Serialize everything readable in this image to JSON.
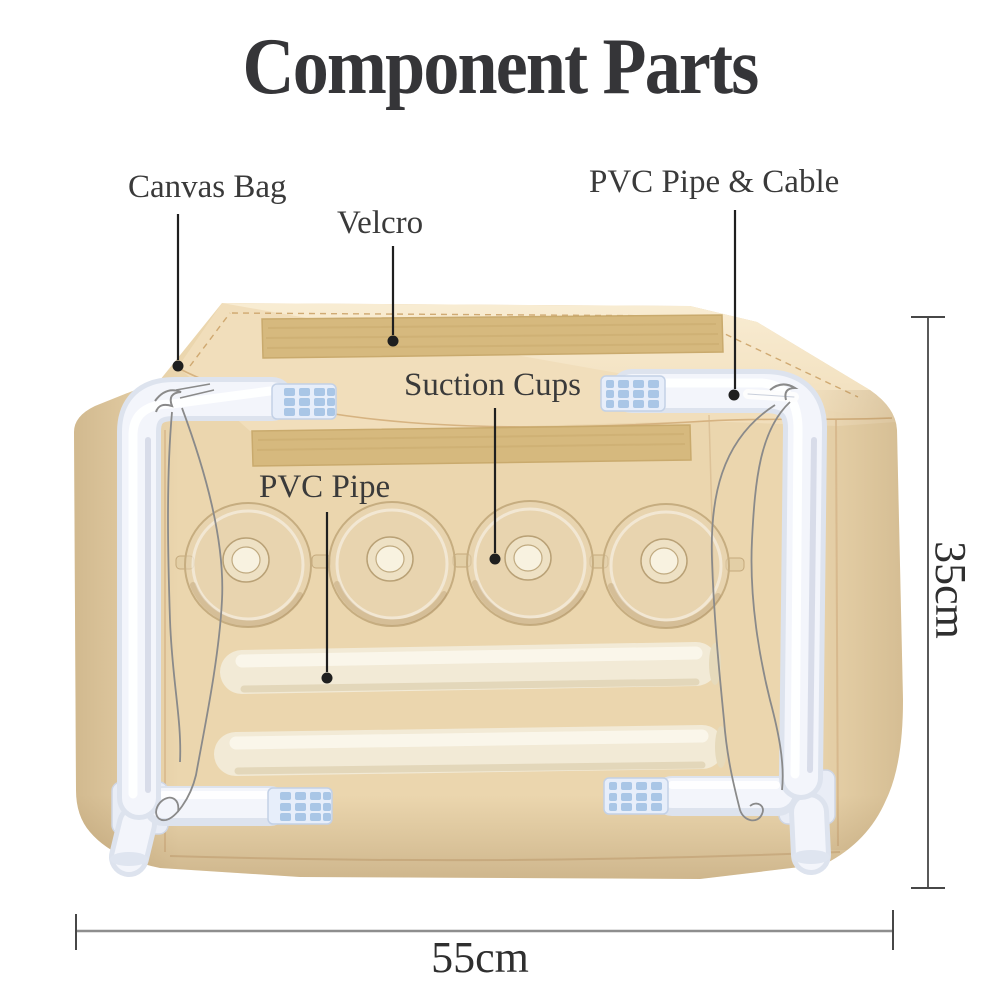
{
  "title": "Component Parts",
  "annotations": {
    "canvas_bag": "Canvas Bag",
    "velcro": "Velcro",
    "pvc_pipe_cable": "PVC Pipe & Cable",
    "suction_cups": "Suction Cups",
    "pvc_pipe": "PVC Pipe"
  },
  "dimensions": {
    "bag_height": "35cm",
    "bag_width": "55cm"
  },
  "colors": {
    "fabric": "#ebd6ae",
    "fabric_light": "#f1debb",
    "fabric_dark": "#dfc69a",
    "fabric_deep": "#c9a878",
    "seam": "#c99f63",
    "velcro": "#d6b97e",
    "velcro_dark": "#c3a263",
    "pipe_base": "#dde3ee",
    "pipe_mid": "#f3f5fb",
    "pipe_hi": "#ffffff",
    "pipe_cream": "#f2ead6",
    "pipe_cream_hi": "#fbf7ec",
    "pipe_cream_sh": "#d9c9a6",
    "connector_base": "#e7eefa",
    "connector_slat": "#a9c6e6",
    "cable": "#8a8a8a",
    "ink": "#1f1f1f",
    "dim_gray": "#8e8e8e"
  }
}
